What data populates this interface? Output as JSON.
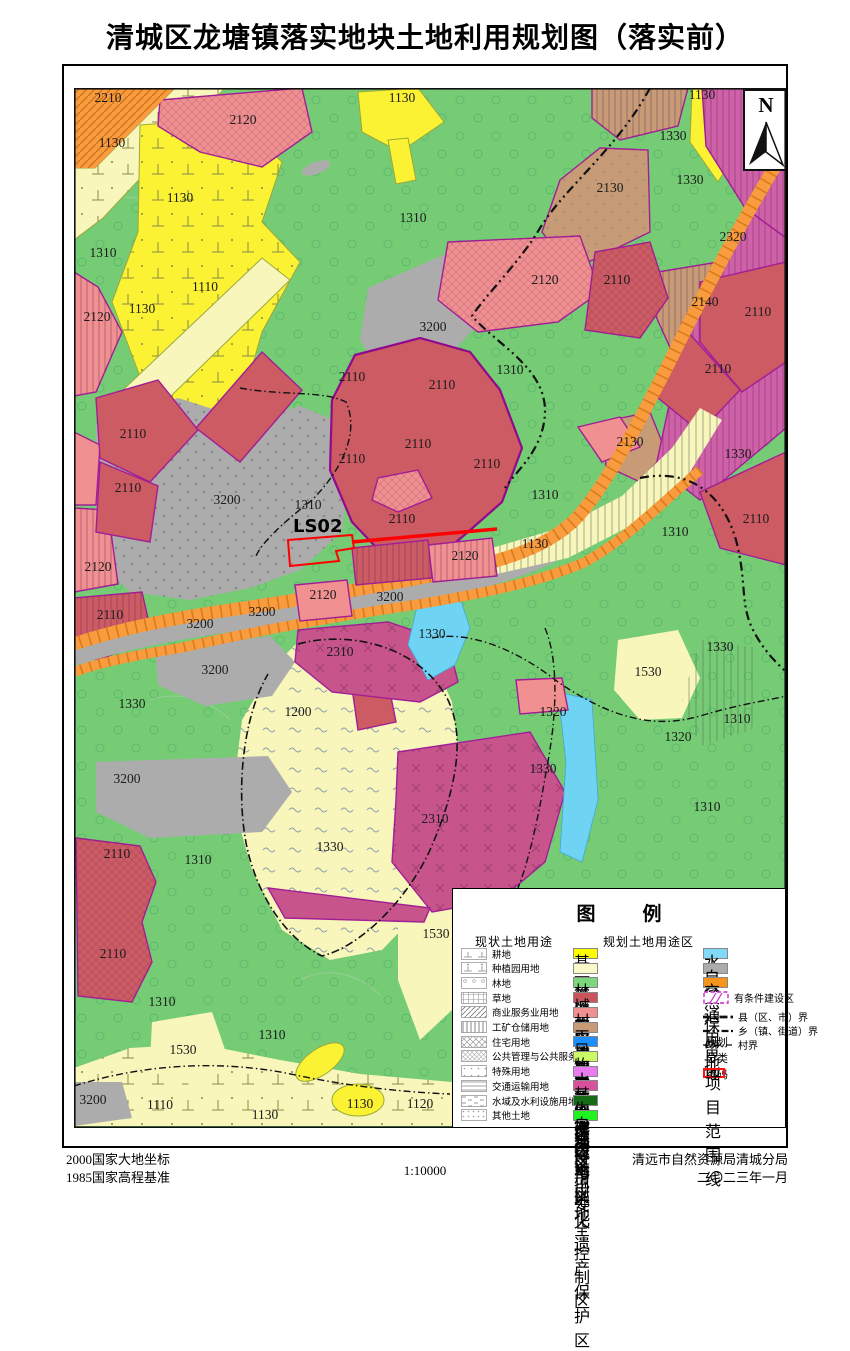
{
  "page": {
    "title": "清城区龙塘镇落实地块土地利用规划图（落实前）"
  },
  "map": {
    "north_label": "N",
    "project_code_label": "LS02",
    "labels": [
      {
        "t": "2210",
        "x": 108,
        "y": 102
      },
      {
        "t": "2120",
        "x": 243,
        "y": 124
      },
      {
        "t": "1130",
        "x": 402,
        "y": 102
      },
      {
        "t": "1330",
        "x": 673,
        "y": 140
      },
      {
        "t": "1130",
        "x": 702,
        "y": 99
      },
      {
        "t": "2320",
        "x": 757,
        "y": 167
      },
      {
        "t": "1130",
        "x": 112,
        "y": 147
      },
      {
        "t": "2130",
        "x": 610,
        "y": 192
      },
      {
        "t": "1330",
        "x": 690,
        "y": 184
      },
      {
        "t": "1130",
        "x": 180,
        "y": 202
      },
      {
        "t": "2320",
        "x": 733,
        "y": 241
      },
      {
        "t": "1310",
        "x": 413,
        "y": 222
      },
      {
        "t": "2140",
        "x": 705,
        "y": 306
      },
      {
        "t": "2110",
        "x": 617,
        "y": 284
      },
      {
        "t": "2120",
        "x": 545,
        "y": 284
      },
      {
        "t": "1310",
        "x": 103,
        "y": 257
      },
      {
        "t": "2110",
        "x": 758,
        "y": 316
      },
      {
        "t": "1110",
        "x": 205,
        "y": 291
      },
      {
        "t": "2110",
        "x": 718,
        "y": 373
      },
      {
        "t": "1130",
        "x": 142,
        "y": 313
      },
      {
        "t": "3200",
        "x": 433,
        "y": 331
      },
      {
        "t": "2120",
        "x": 97,
        "y": 321
      },
      {
        "t": "1310",
        "x": 510,
        "y": 374
      },
      {
        "t": "2110",
        "x": 352,
        "y": 381
      },
      {
        "t": "2110",
        "x": 442,
        "y": 389
      },
      {
        "t": "1330",
        "x": 738,
        "y": 458
      },
      {
        "t": "2110",
        "x": 133,
        "y": 438
      },
      {
        "t": "2110",
        "x": 418,
        "y": 448
      },
      {
        "t": "2130",
        "x": 630,
        "y": 446
      },
      {
        "t": "2110",
        "x": 352,
        "y": 463
      },
      {
        "t": "2110",
        "x": 487,
        "y": 468
      },
      {
        "t": "2110",
        "x": 128,
        "y": 492
      },
      {
        "t": "3200",
        "x": 227,
        "y": 504
      },
      {
        "t": "1310",
        "x": 308,
        "y": 509
      },
      {
        "t": "1310",
        "x": 545,
        "y": 499
      },
      {
        "t": "2110",
        "x": 402,
        "y": 523
      },
      {
        "t": "1130",
        "x": 535,
        "y": 548
      },
      {
        "t": "2120",
        "x": 465,
        "y": 560
      },
      {
        "t": "2110",
        "x": 756,
        "y": 523
      },
      {
        "t": "1310",
        "x": 675,
        "y": 536
      },
      {
        "t": "2120",
        "x": 98,
        "y": 571
      },
      {
        "t": "3200",
        "x": 390,
        "y": 601
      },
      {
        "t": "2120",
        "x": 323,
        "y": 599
      },
      {
        "t": "3200",
        "x": 262,
        "y": 616
      },
      {
        "t": "2110",
        "x": 110,
        "y": 619
      },
      {
        "t": "3200",
        "x": 200,
        "y": 628
      },
      {
        "t": "1330",
        "x": 432,
        "y": 638
      },
      {
        "t": "2310",
        "x": 340,
        "y": 656
      },
      {
        "t": "1330",
        "x": 132,
        "y": 708
      },
      {
        "t": "3200",
        "x": 215,
        "y": 674
      },
      {
        "t": "1530",
        "x": 648,
        "y": 676
      },
      {
        "t": "1330",
        "x": 720,
        "y": 651
      },
      {
        "t": "1200",
        "x": 298,
        "y": 716
      },
      {
        "t": "1320",
        "x": 553,
        "y": 716
      },
      {
        "t": "1310",
        "x": 737,
        "y": 723
      },
      {
        "t": "1320",
        "x": 678,
        "y": 741
      },
      {
        "t": "1330",
        "x": 543,
        "y": 773
      },
      {
        "t": "3200",
        "x": 127,
        "y": 783
      },
      {
        "t": "2310",
        "x": 435,
        "y": 823
      },
      {
        "t": "1310",
        "x": 707,
        "y": 811
      },
      {
        "t": "1330",
        "x": 330,
        "y": 851
      },
      {
        "t": "2110",
        "x": 117,
        "y": 858
      },
      {
        "t": "1310",
        "x": 198,
        "y": 864
      },
      {
        "t": "1530",
        "x": 436,
        "y": 938
      },
      {
        "t": "2110",
        "x": 113,
        "y": 958
      },
      {
        "t": "1310",
        "x": 162,
        "y": 1006
      },
      {
        "t": "1530",
        "x": 183,
        "y": 1054
      },
      {
        "t": "1310",
        "x": 272,
        "y": 1039
      },
      {
        "t": "3200",
        "x": 93,
        "y": 1104
      },
      {
        "t": "1110",
        "x": 160,
        "y": 1109
      },
      {
        "t": "1130",
        "x": 265,
        "y": 1119
      },
      {
        "t": "1130",
        "x": 360,
        "y": 1108
      },
      {
        "t": "1120",
        "x": 420,
        "y": 1108
      }
    ]
  },
  "legend": {
    "title": "图　例",
    "sections": {
      "current": "现状土地用途",
      "planned": "规划土地用途区"
    },
    "current_items": [
      {
        "label": "耕地",
        "pattern": "lp-gengdi"
      },
      {
        "label": "种植园用地",
        "pattern": "lp-zhongzhiyuan"
      },
      {
        "label": "林地",
        "pattern": "lp-lindi"
      },
      {
        "label": "草地",
        "pattern": "lp-caodi"
      },
      {
        "label": "商业服务业用地",
        "pattern": "lp-shangye"
      },
      {
        "label": "工矿仓储用地",
        "pattern": "lp-gongkuang"
      },
      {
        "label": "住宅用地",
        "pattern": "lp-zhuzhai"
      },
      {
        "label": "公共管理与公共服务用地",
        "pattern": "lp-gonggong"
      },
      {
        "label": "特殊用地",
        "pattern": "lp-teshu"
      },
      {
        "label": "交通运输用地",
        "pattern": "lp-jiaoyun"
      },
      {
        "label": "水域及水利设施用地",
        "pattern": "lp-shuili"
      },
      {
        "label": "其他土地",
        "pattern": "lp-qita"
      }
    ],
    "planned_items": [
      {
        "label": "基本农田保护区",
        "color": "#FDFD00"
      },
      {
        "label": "一般农地区",
        "color": "#FBF9C8"
      },
      {
        "label": "林业用地区",
        "color": "#7BD77B"
      },
      {
        "label": "城镇建设用地区",
        "color": "#C9545C"
      },
      {
        "label": "村镇建设用地区",
        "color": "#F19090"
      },
      {
        "label": "工矿用地区",
        "color": "#C79B76"
      },
      {
        "label": "风景旅游用地区",
        "color": "#1D8EFE"
      },
      {
        "label": "牧业用地区",
        "color": "#CCF966"
      },
      {
        "label": "水工建筑用地",
        "color": "#E87BF0"
      },
      {
        "label": "其他建设用地",
        "color": "#D9519E"
      },
      {
        "label": "生态环境安全控制区",
        "color": "#156A15"
      },
      {
        "label": "自然与文化遗产保护区",
        "color": "#21F321"
      }
    ],
    "zone_items": [
      {
        "label": "水域",
        "type": "color",
        "color": "#7FD9F7"
      },
      {
        "label": "自然保留地",
        "type": "color",
        "color": "#ACACAC"
      },
      {
        "label": "交通用地",
        "type": "color",
        "color": "#F7941E"
      },
      {
        "label": "有条件建设区",
        "type": "conditional",
        "color": "#CC29CC"
      },
      {
        "label": "县（区、市）界",
        "type": "line",
        "dash": "8 3 2.5 3",
        "width": 2.8
      },
      {
        "label": "乡（镇、街道）界",
        "type": "line",
        "dash": "7 2.5 2 2.5 2 2.5",
        "width": 2.2
      },
      {
        "label": "村界",
        "type": "line",
        "dash": "6 2 1.5 2",
        "width": 1.2
      },
      {
        "label": "规划分类编码",
        "type": "code",
        "symbol": "1100"
      },
      {
        "label": "项目范围线",
        "type": "rect",
        "color": "#FF1111"
      }
    ]
  },
  "footer": {
    "coord_system": "2000国家大地坐标",
    "height_datum": "1985国家高程基准",
    "scale": "1:10000",
    "agency": "清远市自然资源局清城分局",
    "date": "二〇二三年一月"
  },
  "colors": {
    "forest_green": "#75CC75",
    "basic_farmland_yellow": "#FBF233",
    "general_agri_pale": "#F9F6BC",
    "town_construction_red": "#CC5B63",
    "village_construction_pink": "#F19090",
    "mining_tan": "#C79B76",
    "other_construction_magenta": "#D060A8",
    "nature_reserve_gray": "#ACACAC",
    "road_orange": "#F89C3F",
    "water_blue": "#6FD4F4",
    "project_boundary_red": "#FF0000",
    "zone_border_purple": "#A21E96"
  }
}
